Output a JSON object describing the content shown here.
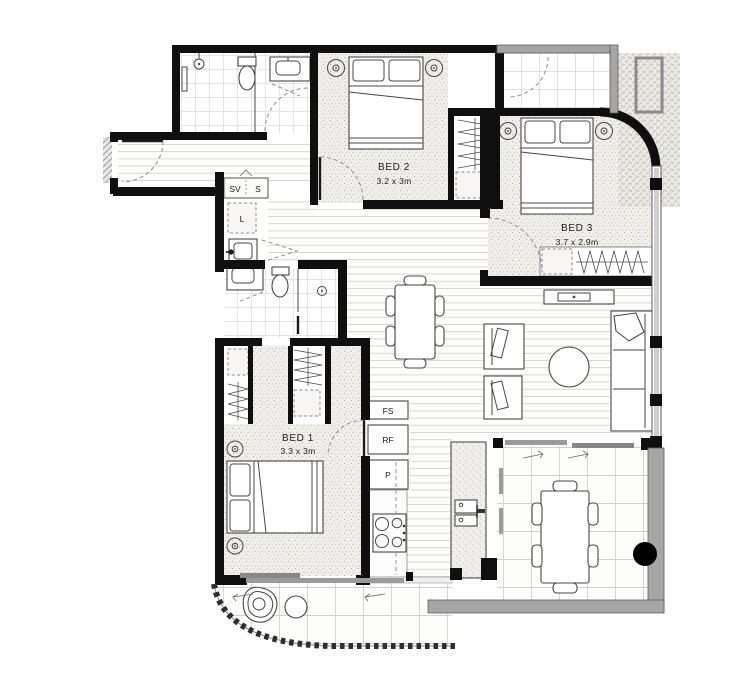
{
  "plan": {
    "type": "apartment-floor-plan",
    "rooms": [
      {
        "name": "BED 1",
        "dims": "3.3 x 3m"
      },
      {
        "name": "BED 2",
        "dims": "3.2 x 3m"
      },
      {
        "name": "BED 3",
        "dims": "3.7 x 2.9m"
      }
    ],
    "closets": {
      "sv": "SV",
      "s": "S",
      "linen": "L"
    },
    "appliances": {
      "fs": "FS",
      "rf": "RF",
      "p": "P"
    },
    "colors": {
      "wall": "#0f0f0f",
      "balcony_wall": "#a6a6a6",
      "window_gray": "#cfcfcf",
      "carpet_dot": "#b7b3ab",
      "column": "#000000"
    }
  }
}
